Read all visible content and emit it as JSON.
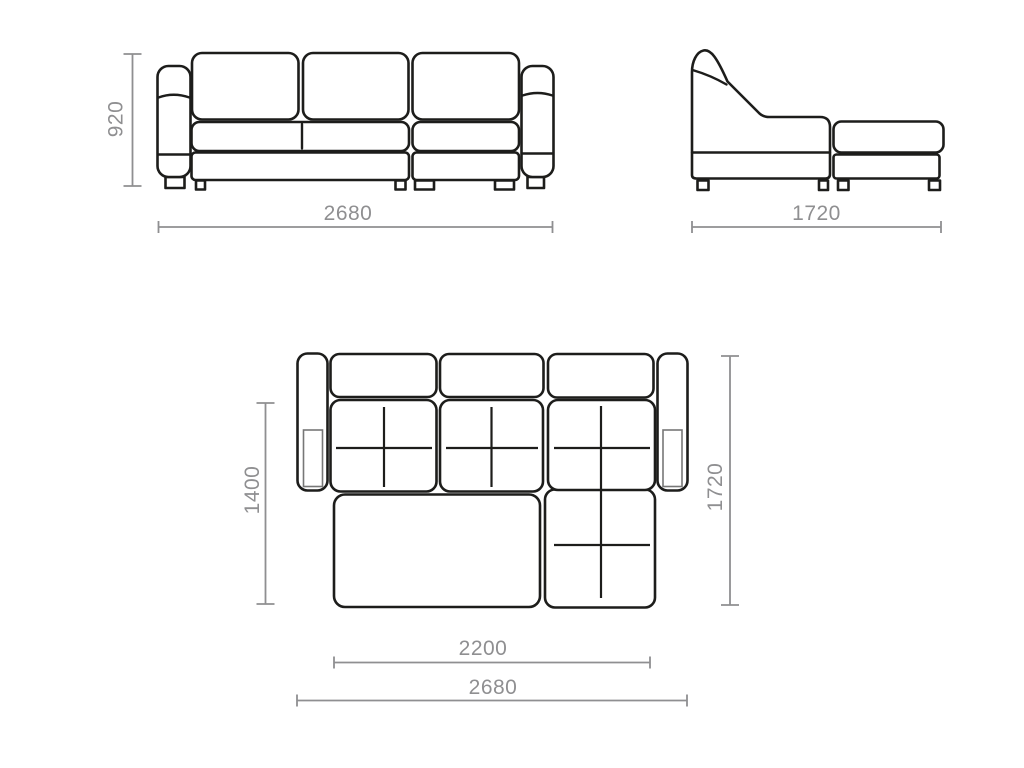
{
  "dims": {
    "front_height": "920",
    "front_width": "2680",
    "side_depth": "1720",
    "top_seat_depth": "1400",
    "top_total_depth": "1720",
    "top_bed_length": "2200",
    "top_total_width": "2680"
  },
  "colors": {
    "outline": "#1d1d1b",
    "dim": "#8f8f91",
    "inner": "#777777",
    "bg": "#ffffff"
  }
}
